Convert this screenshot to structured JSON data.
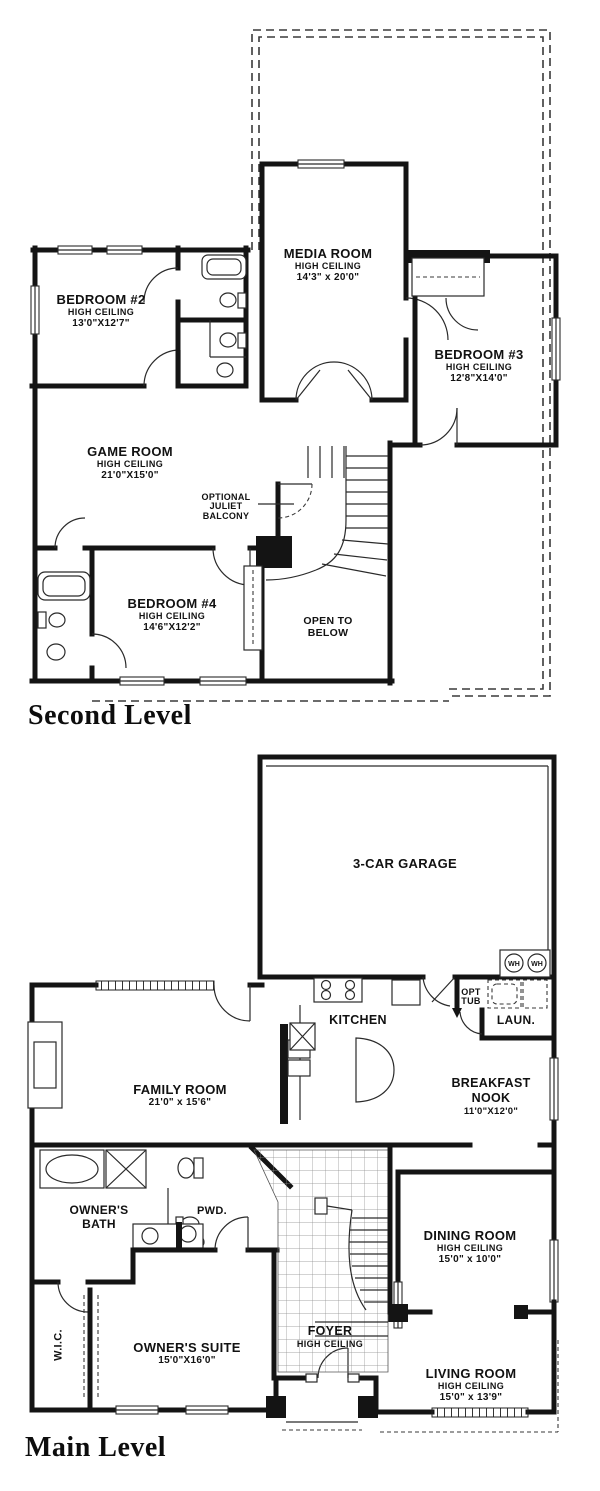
{
  "colors": {
    "ink": "#141414",
    "paper": "#ffffff"
  },
  "second": {
    "heading": "Second Level",
    "bedroom2": {
      "name": "BEDROOM #2",
      "ceiling": "HIGH CEILING",
      "dims": "13'0\"X12'7\""
    },
    "media": {
      "name": "MEDIA ROOM",
      "ceiling": "HIGH CEILING",
      "dims": "14'3\" x 20'0\""
    },
    "bedroom3": {
      "name": "BEDROOM #3",
      "ceiling": "HIGH CEILING",
      "dims": "12'8\"X14'0\""
    },
    "game": {
      "name": "GAME ROOM",
      "ceiling": "HIGH CEILING",
      "dims": "21'0\"X15'0\""
    },
    "juliet": {
      "name": "OPTIONAL JULIET BALCONY"
    },
    "bedroom4": {
      "name": "BEDROOM #4",
      "ceiling": "HIGH CEILING",
      "dims": "14'6\"X12'2\""
    },
    "open_below": {
      "name": "OPEN TO BELOW"
    }
  },
  "main": {
    "heading": "Main Level",
    "garage": {
      "name": "3-CAR GARAGE"
    },
    "wh": "WH",
    "kitchen": {
      "name": "KITCHEN"
    },
    "opt_tub": {
      "name": "OPT TUB"
    },
    "laundry": {
      "name": "LAUN."
    },
    "breakfast": {
      "name": "BREAKFAST NOOK",
      "dims": "11'0\"X12'0\""
    },
    "family": {
      "name": "FAMILY ROOM",
      "dims": "21'0\" x 15'6\""
    },
    "owners_bath": {
      "name": "OWNER'S BATH"
    },
    "pwd": {
      "name": "PWD."
    },
    "dining": {
      "name": "DINING ROOM",
      "ceiling": "HIGH CEILING",
      "dims": "15'0\" x 10'0\""
    },
    "wic": {
      "name": "W.I.C."
    },
    "owners_suite": {
      "name": "OWNER'S SUITE",
      "dims": "15'0\"X16'0\""
    },
    "foyer": {
      "name": "FOYER",
      "ceiling": "HIGH CEILING"
    },
    "living": {
      "name": "LIVING ROOM",
      "ceiling": "HIGH CEILING",
      "dims": "15'0\" x 13'9\""
    }
  }
}
